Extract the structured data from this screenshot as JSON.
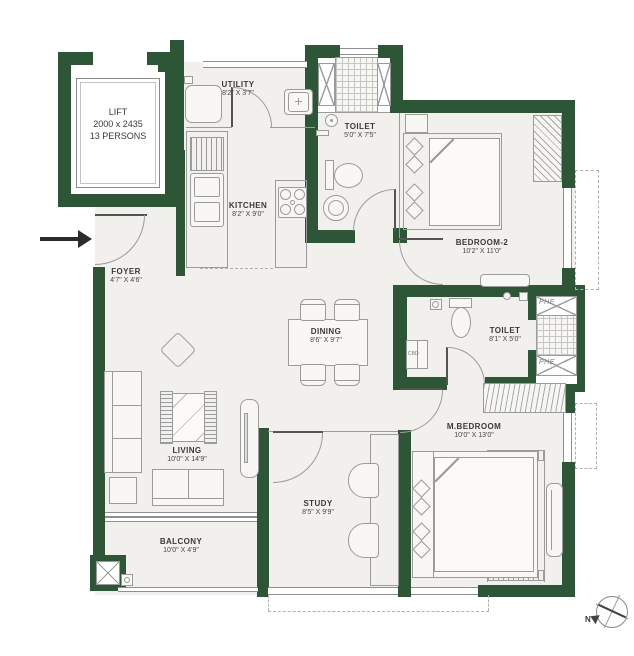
{
  "colors": {
    "wall_green": "#2c5635",
    "floor_fill": "#f2f0ec",
    "line_grey": "#9b9b9b",
    "text": "#3a3a3a"
  },
  "lift": {
    "label": "LIFT",
    "size": "2000 x 2435",
    "capacity": "13 PERSONS"
  },
  "rooms": {
    "utility": {
      "name": "UTILITY",
      "dims": "8'2\" X 3'7\""
    },
    "toilet1": {
      "name": "TOILET",
      "dims": "5'0\" X 7'5\""
    },
    "kitchen": {
      "name": "KITCHEN",
      "dims": "8'2\" X 9'0\""
    },
    "bedroom2": {
      "name": "BEDROOM-2",
      "dims": "10'2\" X 11'0\""
    },
    "foyer": {
      "name": "FOYER",
      "dims": "4'7\" X 4'6\""
    },
    "dining": {
      "name": "DINING",
      "dims": "8'6\" X 9'7\""
    },
    "toilet2": {
      "name": "TOILET",
      "dims": "8'1\" X 5'0\""
    },
    "living": {
      "name": "LIVING",
      "dims": "10'0\" X 14'9\""
    },
    "mbedroom": {
      "name": "M.BEDROOM",
      "dims": "10'0\" X 13'0\""
    },
    "study": {
      "name": "STUDY",
      "dims": "8'5\" X 9'9\""
    },
    "balcony": {
      "name": "BALCONY",
      "dims": "10'0\" X 4'9\""
    }
  },
  "labels": {
    "phe": "PHE",
    "cbd": "CBD",
    "north": "N"
  }
}
